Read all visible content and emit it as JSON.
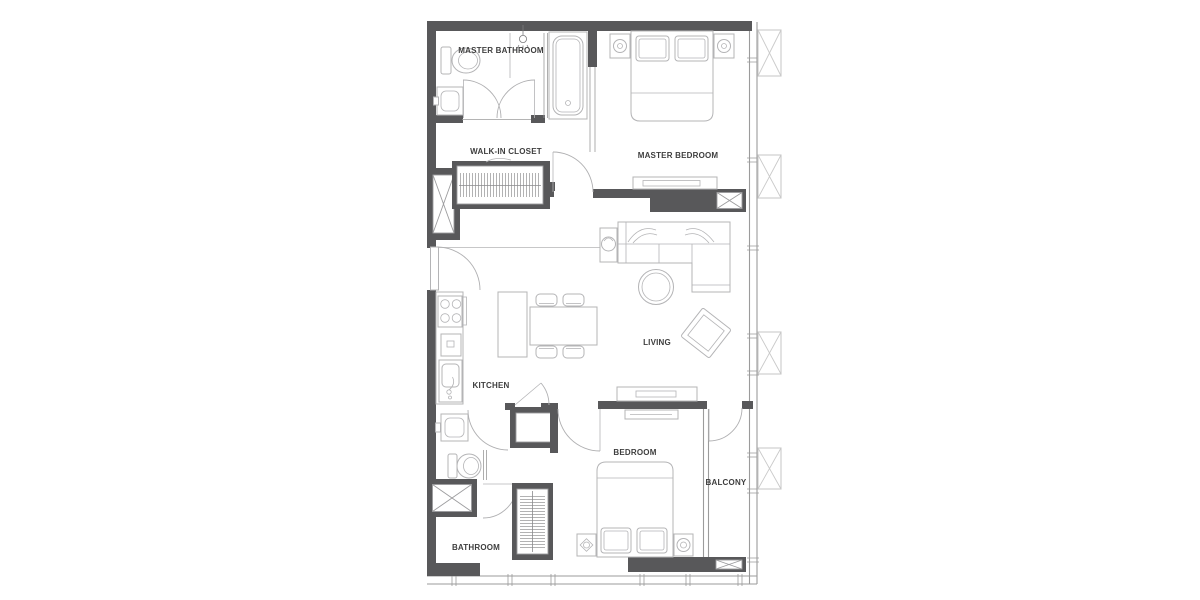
{
  "colors": {
    "wall": "#58585a",
    "furniture_line": "#b4b4b6",
    "window_line": "#9b9b9b",
    "box_line": "#c9c9c9",
    "text": "#3e3e3e",
    "background": "#ffffff"
  },
  "plan": {
    "type": "apartment-floor-plan",
    "rooms": {
      "master_bathroom": {
        "label": "MASTER BATHROOM",
        "fixtures": [
          "toilet",
          "washbasin",
          "bathtub",
          "shower-head",
          "double-swing-door"
        ]
      },
      "walk_in_closet": {
        "label": "WALK-IN CLOSET",
        "fixtures": [
          "wardrobe-with-hangers"
        ]
      },
      "master_bedroom": {
        "label": "MASTER BEDROOM",
        "fixtures": [
          "double-bed",
          "pillows",
          "nightstand-left",
          "nightstand-right",
          "tv-console"
        ]
      },
      "living": {
        "label": "LIVING",
        "fixtures": [
          "l-shaped-sofa",
          "side-table-with-plant",
          "round-coffee-table",
          "lounge-chair",
          "tv-console"
        ]
      },
      "kitchen": {
        "label": "KITCHEN",
        "fixtures": [
          "cooktop",
          "counter",
          "kitchen-sink",
          "island",
          "dining-table",
          "four-chairs"
        ]
      },
      "bathroom": {
        "label": "BATHROOM",
        "fixtures": [
          "washbasin",
          "toilet",
          "shower"
        ]
      },
      "bedroom": {
        "label": "BEDROOM",
        "fixtures": [
          "double-bed",
          "pillows",
          "nightstand-left",
          "nightstand-right",
          "dresser",
          "wardrobe-with-hangers"
        ]
      },
      "balcony": {
        "label": "BALCONY",
        "fixtures": [
          "swing-door"
        ]
      }
    },
    "exterior": {
      "ac_box_count": 4,
      "window_walls": [
        "right",
        "bottom"
      ]
    }
  }
}
